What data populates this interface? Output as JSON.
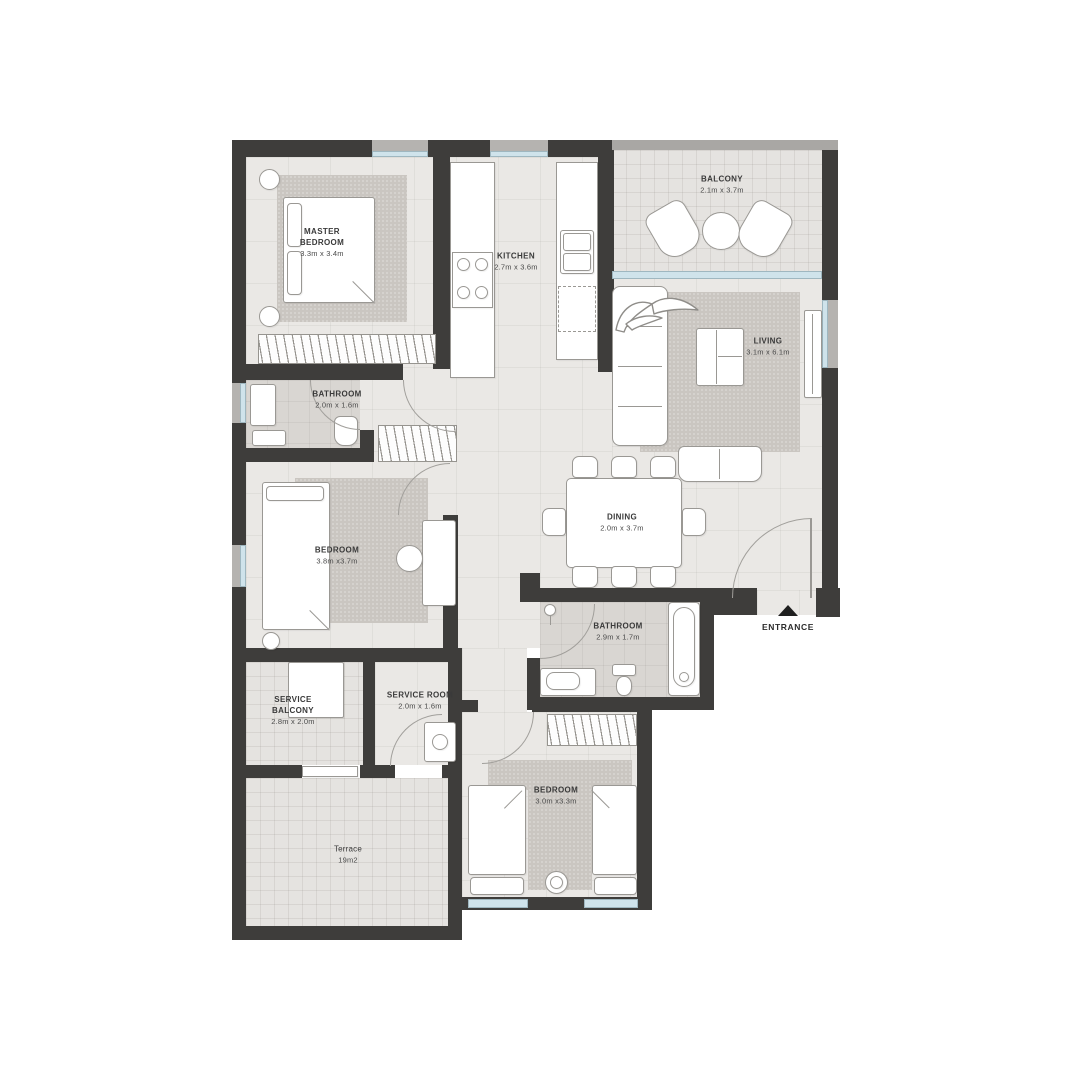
{
  "plan": {
    "rooms": [
      {
        "id": "master-bedroom",
        "name": "MASTER BEDROOM",
        "dims": "3.3m x 3.4m"
      },
      {
        "id": "kitchen",
        "name": "KITCHEN",
        "dims": "2.7m x 3.6m"
      },
      {
        "id": "balcony",
        "name": "BALCONY",
        "dims": "2.1m x 3.7m"
      },
      {
        "id": "living",
        "name": "LIVING",
        "dims": "3.1m x 6.1m"
      },
      {
        "id": "bathroom-1",
        "name": "BATHROOM",
        "dims": "2.0m x 1.6m"
      },
      {
        "id": "bedroom-1",
        "name": "BEDROOM",
        "dims": "3.8m x3.7m"
      },
      {
        "id": "dining",
        "name": "DINING",
        "dims": "2.0m x 3.7m"
      },
      {
        "id": "bathroom-2",
        "name": "BATHROOM",
        "dims": "2.9m x 1.7m"
      },
      {
        "id": "service-balcony",
        "name": "SERVICE BALCONY",
        "dims": "2.8m x 2.0m"
      },
      {
        "id": "service-room",
        "name": "SERVICE ROOM",
        "dims": "2.0m x 1.6m"
      },
      {
        "id": "bedroom-2",
        "name": "BEDROOM",
        "dims": "3.0m x3.3m"
      },
      {
        "id": "terrace",
        "name": "Terrace",
        "dims": "19m2"
      }
    ],
    "entrance_label": "ENTRANCE",
    "colors": {
      "wall": "#3e3d3b",
      "floor": "#eae8e5",
      "rug": "#cac6c1",
      "wet_floor": "#d9d6d2",
      "glass": "#cfe3eb",
      "furniture_stroke": "#9a9894"
    }
  }
}
